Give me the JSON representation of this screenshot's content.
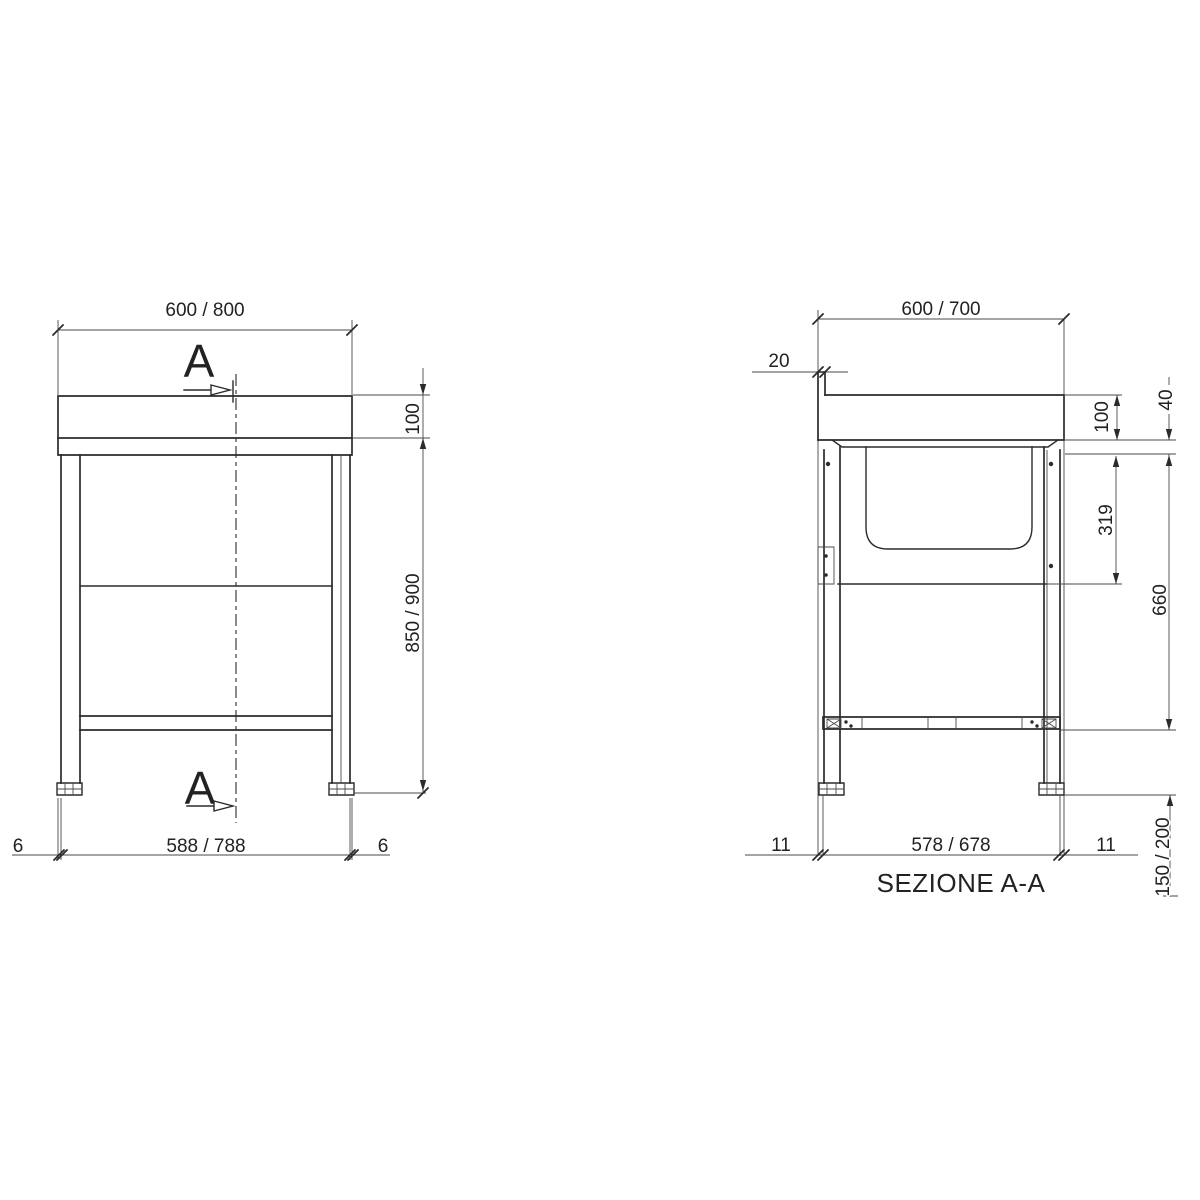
{
  "drawing": {
    "section_title": "SEZIONE A-A",
    "cut_label_top": "A",
    "cut_label_bottom": "A",
    "line_color": "#2b2b2b",
    "background": "#ffffff",
    "front_view": {
      "dim_width_top": "600 / 800",
      "dim_top_height": "100",
      "dim_body_height": "850 / 900",
      "dim_edge_left": "6",
      "dim_leg_span": "588 / 788",
      "dim_edge_right": "6"
    },
    "section_view": {
      "dim_depth_top": "600 / 700",
      "dim_splash_thickness": "20",
      "dim_top_height": "100",
      "dim_edge_height": "40",
      "dim_bowl_depth": "319",
      "dim_under_top_height": "660",
      "dim_edge_left": "11",
      "dim_leg_span": "578 / 678",
      "dim_edge_right": "11",
      "dim_foot_height": "150 / 200"
    }
  }
}
